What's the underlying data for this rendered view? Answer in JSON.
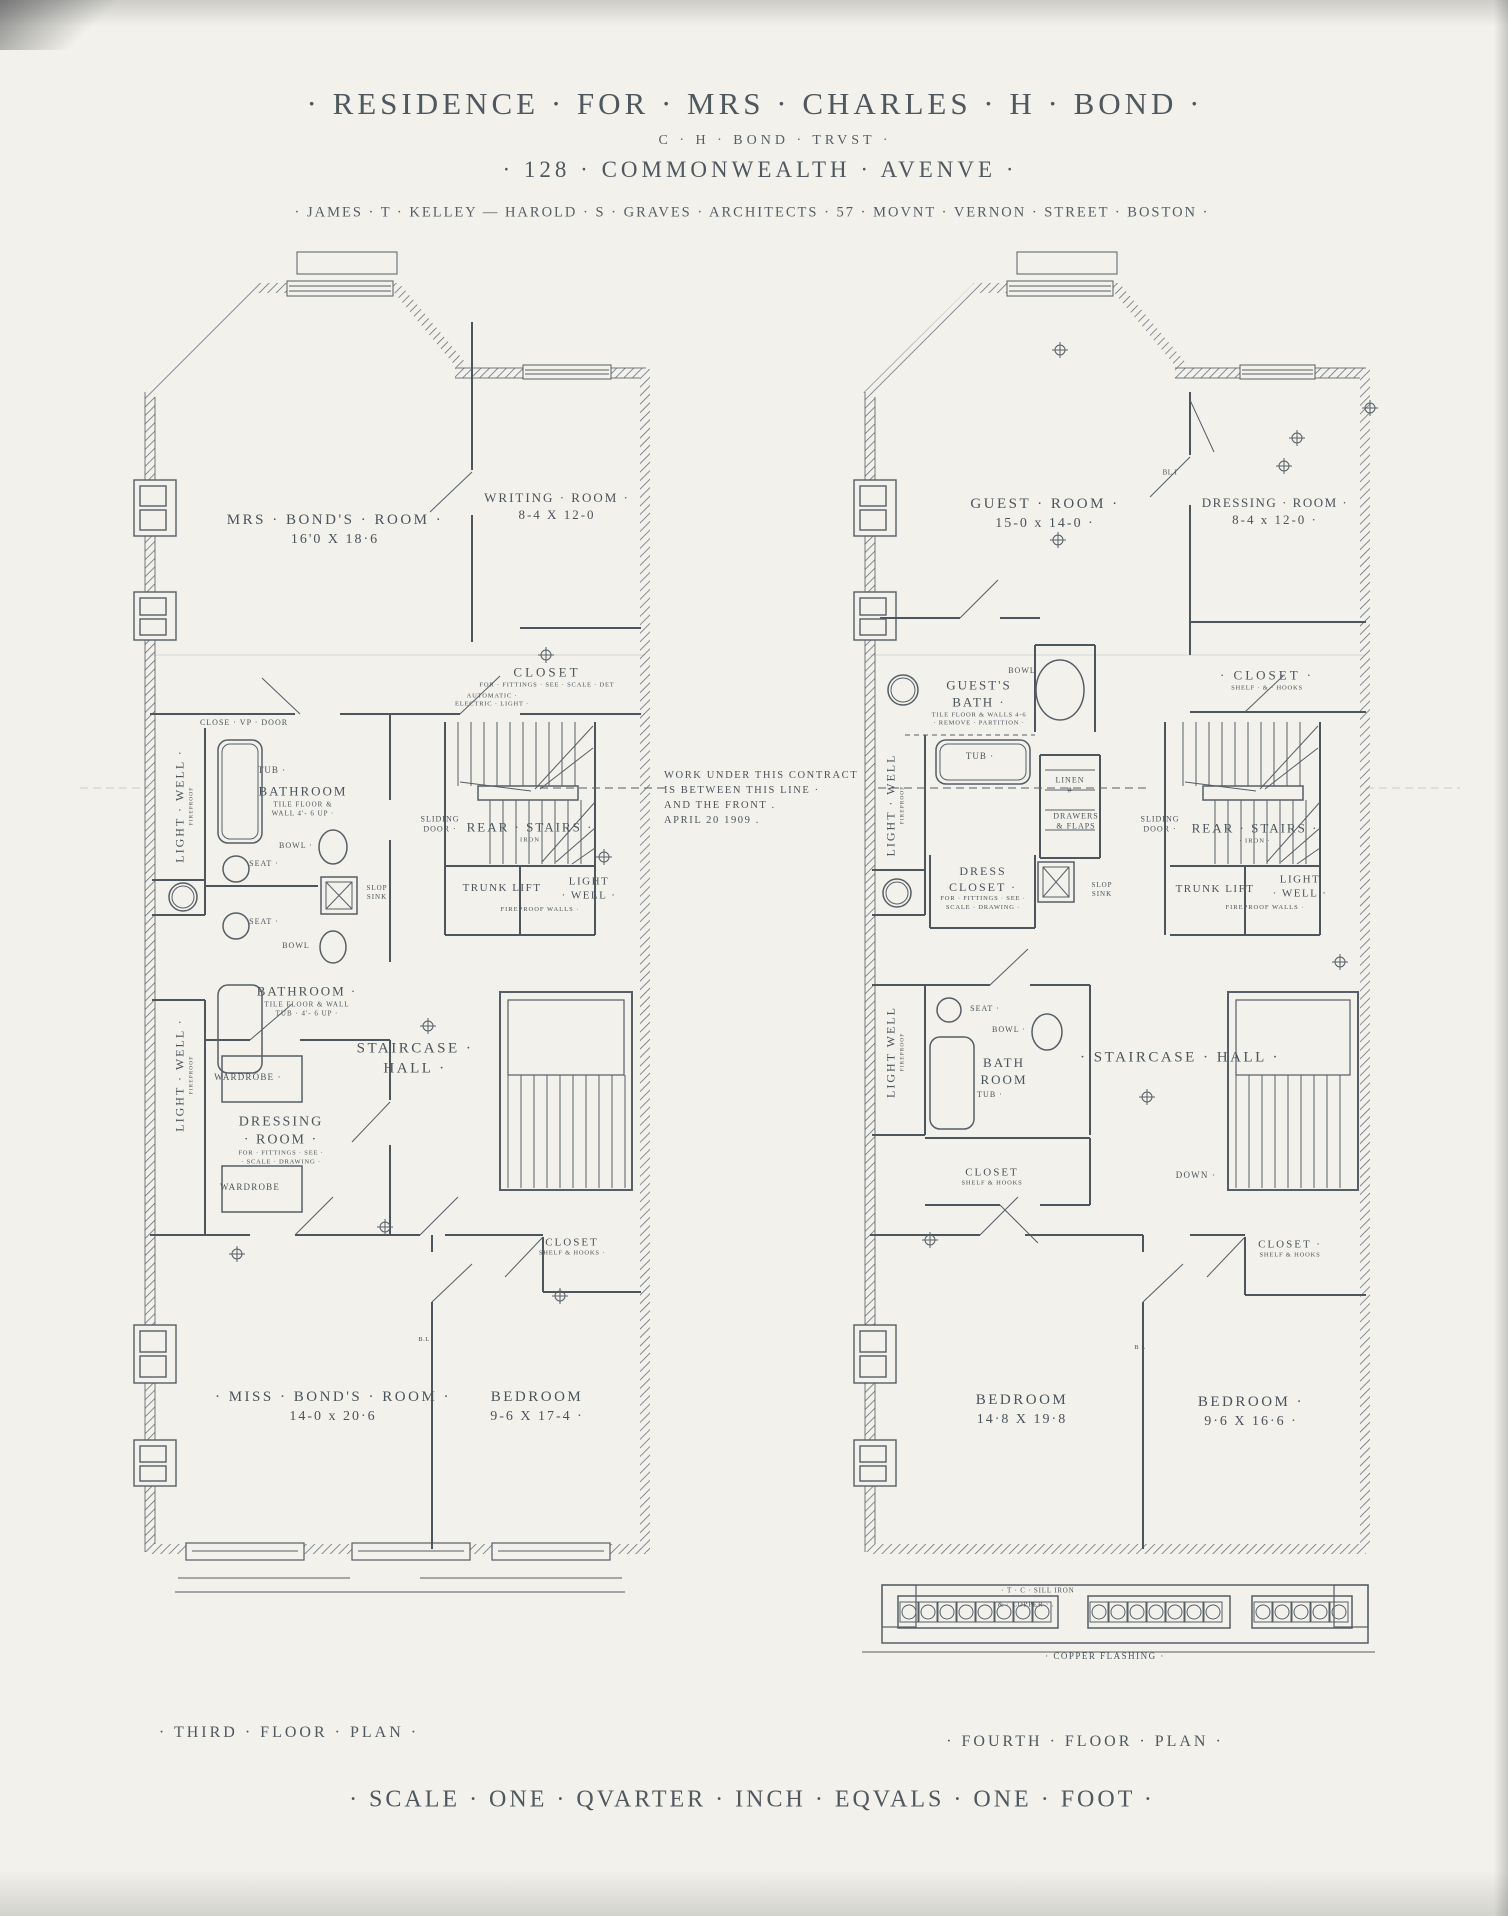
{
  "header": {
    "title": "· RESIDENCE · FOR · MRS · CHARLES · H · BOND ·",
    "trust": "C · H · BOND · TRVST ·",
    "address": "· 128 · COMMONWEALTH · AVENVE ·",
    "architects": "· JAMES · T · KELLEY — HAROLD · S · GRAVES · ARCHITECTS · 57 · MOVNT · VERNON · STREET · BOSTON ·"
  },
  "note": {
    "lines": [
      "WORK UNDER THIS CONTRACT",
      "IS  BETWEEN THIS LINE ·",
      "AND THE FRONT .",
      "APRIL 20 1909 ."
    ]
  },
  "footer": {
    "scale": "· SCALE · ONE · QVARTER · INCH · EQVALS · ONE · FOOT ·"
  },
  "plans": {
    "third": {
      "caption": "· THIRD · FLOOR · PLAN ·",
      "labels": [
        {
          "x": 335,
          "y": 530,
          "lines": [
            {
              "t": "MRS · BOND'S · ROOM ·",
              "fs": 15,
              "ls": 2.5
            },
            {
              "t": "16'0 X 18·6",
              "fs": 14,
              "ls": 2
            }
          ]
        },
        {
          "x": 557,
          "y": 507,
          "lines": [
            {
              "t": "WRITING · ROOM ·",
              "fs": 13,
              "ls": 2
            },
            {
              "t": "8-4 X 12-0",
              "fs": 13,
              "ls": 2
            }
          ]
        },
        {
          "x": 547,
          "y": 677,
          "lines": [
            {
              "t": "CLOSET",
              "fs": 13,
              "ls": 3
            },
            {
              "t": "FOR · FITTINGS · SEE · SCALE · DET",
              "fs": 6.5,
              "ls": 0.8
            }
          ]
        },
        {
          "x": 492,
          "y": 701,
          "lines": [
            {
              "t": "AUTOMATIC ·",
              "fs": 6.5,
              "ls": 0.8
            },
            {
              "t": "ELECTRIC · LIGHT ·",
              "fs": 6.5,
              "ls": 0.8
            }
          ]
        },
        {
          "x": 244,
          "y": 723,
          "lines": [
            {
              "t": "CLOSE · VP · DOOR",
              "fs": 8,
              "ls": 1
            }
          ]
        },
        {
          "x": 184,
          "y": 806,
          "rot": -90,
          "lines": [
            {
              "t": "LIGHT · WELL ·",
              "fs": 12,
              "ls": 2
            },
            {
              "t": "FIREPROOF",
              "fs": 5.5,
              "ls": 1
            }
          ]
        },
        {
          "x": 272,
          "y": 771,
          "lines": [
            {
              "t": "TUB ·",
              "fs": 9,
              "ls": 1
            }
          ]
        },
        {
          "x": 303,
          "y": 801,
          "lines": [
            {
              "t": "BATHROOM",
              "fs": 13,
              "ls": 2
            },
            {
              "t": "TILE  FLOOR  &",
              "fs": 7,
              "ls": 1
            },
            {
              "t": "WALL 4'- 6 UP ·",
              "fs": 7,
              "ls": 1
            }
          ]
        },
        {
          "x": 296,
          "y": 846,
          "lines": [
            {
              "t": "BOWL ·",
              "fs": 8,
              "ls": 1
            }
          ]
        },
        {
          "x": 264,
          "y": 864,
          "lines": [
            {
              "t": "SEAT ·",
              "fs": 8,
              "ls": 1
            }
          ]
        },
        {
          "x": 377,
          "y": 893,
          "lines": [
            {
              "t": "SLOP",
              "fs": 7,
              "ls": 1
            },
            {
              "t": "SINK",
              "fs": 7,
              "ls": 1
            }
          ]
        },
        {
          "x": 264,
          "y": 922,
          "lines": [
            {
              "t": "SEAT ·",
              "fs": 8,
              "ls": 1
            }
          ]
        },
        {
          "x": 296,
          "y": 946,
          "lines": [
            {
              "t": "BOWL",
              "fs": 8,
              "ls": 1
            }
          ]
        },
        {
          "x": 307,
          "y": 1001,
          "lines": [
            {
              "t": "BATHROOM ·",
              "fs": 13,
              "ls": 2
            },
            {
              "t": "TILE FLOOR & WALL",
              "fs": 7,
              "ls": 1
            },
            {
              "t": "TUB · 4'- 6 UP ·",
              "fs": 7,
              "ls": 1
            }
          ]
        },
        {
          "x": 440,
          "y": 825,
          "lines": [
            {
              "t": "SLIDING",
              "fs": 8,
              "ls": 1
            },
            {
              "t": "DOOR ·",
              "fs": 8,
              "ls": 1
            }
          ]
        },
        {
          "x": 530,
          "y": 832,
          "lines": [
            {
              "t": "REAR · STAIRS ·",
              "fs": 13,
              "ls": 2
            },
            {
              "t": "IRON",
              "fs": 6.5,
              "ls": 1
            }
          ]
        },
        {
          "x": 502,
          "y": 888,
          "lines": [
            {
              "t": "TRUNK LIFT",
              "fs": 11,
              "ls": 1.5
            }
          ]
        },
        {
          "x": 589,
          "y": 889,
          "lines": [
            {
              "t": "LIGHT",
              "fs": 11,
              "ls": 1.5
            },
            {
              "t": "· WELL ·",
              "fs": 11,
              "ls": 1.5
            }
          ]
        },
        {
          "x": 540,
          "y": 910,
          "lines": [
            {
              "t": "FIREPROOF  WALLS ·",
              "fs": 6.5,
              "ls": 1
            }
          ]
        },
        {
          "x": 184,
          "y": 1075,
          "rot": -90,
          "lines": [
            {
              "t": "LIGHT · WELL ·",
              "fs": 12,
              "ls": 2
            },
            {
              "t": "FIREPROOF",
              "fs": 5.5,
              "ls": 1
            }
          ]
        },
        {
          "x": 415,
          "y": 1059,
          "lines": [
            {
              "t": "STAIRCASE ·",
              "fs": 15,
              "ls": 2.5
            },
            {
              "t": "HALL ·",
              "fs": 15,
              "ls": 2.5
            }
          ]
        },
        {
          "x": 248,
          "y": 1078,
          "lines": [
            {
              "t": "WARDROBE ·",
              "fs": 9,
              "ls": 1.2
            }
          ]
        },
        {
          "x": 281,
          "y": 1140,
          "lines": [
            {
              "t": "DRESSING",
              "fs": 14,
              "ls": 2
            },
            {
              "t": "· ROOM ·",
              "fs": 14,
              "ls": 2
            },
            {
              "t": "FOR · FITTINGS · SEE ·",
              "fs": 6.5,
              "ls": 0.8
            },
            {
              "t": "· SCALE · DRAWING ·",
              "fs": 6.5,
              "ls": 0.8
            }
          ]
        },
        {
          "x": 250,
          "y": 1188,
          "lines": [
            {
              "t": "WARDROBE",
              "fs": 9,
              "ls": 1.2
            }
          ]
        },
        {
          "x": 572,
          "y": 1247,
          "lines": [
            {
              "t": "CLOSET",
              "fs": 11,
              "ls": 2
            },
            {
              "t": "SHELF & HOOKS ·",
              "fs": 6.5,
              "ls": 0.8
            }
          ]
        },
        {
          "x": 424,
          "y": 1340,
          "lines": [
            {
              "t": "B.L",
              "fs": 6.5,
              "ls": 0.5
            }
          ]
        },
        {
          "x": 333,
          "y": 1407,
          "lines": [
            {
              "t": "· MISS · BOND'S · ROOM ·",
              "fs": 15,
              "ls": 2.5
            },
            {
              "t": "14-0 x 20·6",
              "fs": 14,
              "ls": 2
            }
          ]
        },
        {
          "x": 537,
          "y": 1407,
          "lines": [
            {
              "t": "BEDROOM",
              "fs": 15,
              "ls": 2.5
            },
            {
              "t": "9-6 X 17-4 ·",
              "fs": 14,
              "ls": 2
            }
          ]
        }
      ]
    },
    "fourth": {
      "caption": "· FOURTH · FLOOR · PLAN ·",
      "labels": [
        {
          "x": 1045,
          "y": 514,
          "lines": [
            {
              "t": "GUEST · ROOM ·",
              "fs": 15,
              "ls": 2.5
            },
            {
              "t": "15-0  x  14-0 ·",
              "fs": 14,
              "ls": 2
            }
          ]
        },
        {
          "x": 1275,
          "y": 512,
          "lines": [
            {
              "t": "DRESSING · ROOM ·",
              "fs": 13,
              "ls": 1.5
            },
            {
              "t": "8-4 x 12-0 ·",
              "fs": 13,
              "ls": 2
            }
          ]
        },
        {
          "x": 1170,
          "y": 473,
          "lines": [
            {
              "t": "BL  I",
              "fs": 7,
              "ls": 0.5
            }
          ]
        },
        {
          "x": 1267,
          "y": 680,
          "lines": [
            {
              "t": "· CLOSET ·",
              "fs": 13,
              "ls": 3
            },
            {
              "t": "SHELF · & · HOOKS",
              "fs": 6.5,
              "ls": 0.8
            }
          ]
        },
        {
          "x": 1022,
          "y": 671,
          "lines": [
            {
              "t": "BOWL",
              "fs": 8,
              "ls": 1
            }
          ]
        },
        {
          "x": 979,
          "y": 703,
          "lines": [
            {
              "t": "GUEST'S",
              "fs": 13,
              "ls": 2
            },
            {
              "t": "BATH ·",
              "fs": 13,
              "ls": 2
            },
            {
              "t": "TILE FLOOR & WALLS 4-6",
              "fs": 6.5,
              "ls": 0.8
            },
            {
              "t": "· REMOVE · PARTITION ·",
              "fs": 6.5,
              "ls": 0.8
            }
          ]
        },
        {
          "x": 980,
          "y": 757,
          "lines": [
            {
              "t": "TUB ·",
              "fs": 9,
              "ls": 1
            }
          ]
        },
        {
          "x": 895,
          "y": 805,
          "rot": -90,
          "lines": [
            {
              "t": "LIGHT · WELL",
              "fs": 12,
              "ls": 2
            },
            {
              "t": "FIREPROOF",
              "fs": 5.5,
              "ls": 1
            }
          ]
        },
        {
          "x": 1070,
          "y": 786,
          "lines": [
            {
              "t": "LINEN",
              "fs": 8,
              "ls": 1
            },
            {
              "t": "#",
              "fs": 8,
              "ls": 1
            }
          ]
        },
        {
          "x": 1076,
          "y": 822,
          "lines": [
            {
              "t": "DRAWERS",
              "fs": 8,
              "ls": 1
            },
            {
              "t": "& FLAPS",
              "fs": 8,
              "ls": 1
            }
          ]
        },
        {
          "x": 983,
          "y": 888,
          "lines": [
            {
              "t": "DRESS",
              "fs": 12,
              "ls": 2
            },
            {
              "t": "CLOSET ·",
              "fs": 12,
              "ls": 2
            },
            {
              "t": "FOR · FITTINGS · SEE ·",
              "fs": 6.5,
              "ls": 0.8
            },
            {
              "t": "SCALE · DRAWING ·",
              "fs": 6.5,
              "ls": 0.8
            }
          ]
        },
        {
          "x": 1102,
          "y": 890,
          "lines": [
            {
              "t": "SLOP",
              "fs": 7,
              "ls": 1
            },
            {
              "t": "SINK",
              "fs": 7,
              "ls": 1
            }
          ]
        },
        {
          "x": 1160,
          "y": 825,
          "lines": [
            {
              "t": "SLIDING",
              "fs": 8,
              "ls": 1
            },
            {
              "t": "DOOR ·",
              "fs": 8,
              "ls": 1
            }
          ]
        },
        {
          "x": 1255,
          "y": 833,
          "lines": [
            {
              "t": "REAR · STAIRS ·",
              "fs": 13,
              "ls": 2
            },
            {
              "t": "· IRON ·",
              "fs": 6.5,
              "ls": 1
            }
          ]
        },
        {
          "x": 1215,
          "y": 889,
          "lines": [
            {
              "t": "TRUNK LIFT",
              "fs": 11,
              "ls": 1.5
            }
          ]
        },
        {
          "x": 1300,
          "y": 887,
          "lines": [
            {
              "t": "LIGHT",
              "fs": 11,
              "ls": 1.5
            },
            {
              "t": "· WELL ·",
              "fs": 11,
              "ls": 1.5
            }
          ]
        },
        {
          "x": 1265,
          "y": 908,
          "lines": [
            {
              "t": "FIREPROOF  WALLS ·",
              "fs": 6.5,
              "ls": 1
            }
          ]
        },
        {
          "x": 895,
          "y": 1052,
          "rot": -90,
          "lines": [
            {
              "t": "LIGHT  WELL",
              "fs": 12,
              "ls": 2
            },
            {
              "t": "FIREPROOF",
              "fs": 5.5,
              "ls": 1
            }
          ]
        },
        {
          "x": 985,
          "y": 1009,
          "lines": [
            {
              "t": "SEAT ·",
              "fs": 8,
              "ls": 1
            }
          ]
        },
        {
          "x": 1009,
          "y": 1030,
          "lines": [
            {
              "t": "BOWL ·",
              "fs": 8,
              "ls": 1
            }
          ]
        },
        {
          "x": 1004,
          "y": 1072,
          "lines": [
            {
              "t": "BATH",
              "fs": 13,
              "ls": 2
            },
            {
              "t": "ROOM",
              "fs": 13,
              "ls": 2
            }
          ]
        },
        {
          "x": 990,
          "y": 1095,
          "lines": [
            {
              "t": "TUB ·",
              "fs": 8,
              "ls": 1
            }
          ]
        },
        {
          "x": 1180,
          "y": 1058,
          "lines": [
            {
              "t": "· STAIRCASE · HALL ·",
              "fs": 15,
              "ls": 2.5
            }
          ]
        },
        {
          "x": 992,
          "y": 1177,
          "lines": [
            {
              "t": "CLOSET",
              "fs": 11,
              "ls": 2
            },
            {
              "t": "SHELF & HOOKS",
              "fs": 6.5,
              "ls": 0.8
            }
          ]
        },
        {
          "x": 1196,
          "y": 1176,
          "lines": [
            {
              "t": "DOWN ·",
              "fs": 9,
              "ls": 1.2
            }
          ]
        },
        {
          "x": 1290,
          "y": 1249,
          "lines": [
            {
              "t": "CLOSET ·",
              "fs": 11,
              "ls": 2
            },
            {
              "t": "SHELF & HOOKS",
              "fs": 6.5,
              "ls": 0.8
            }
          ]
        },
        {
          "x": 1140,
          "y": 1348,
          "lines": [
            {
              "t": "B L",
              "fs": 6.5,
              "ls": 0.5
            }
          ]
        },
        {
          "x": 1022,
          "y": 1410,
          "lines": [
            {
              "t": "BEDROOM",
              "fs": 15,
              "ls": 2.5
            },
            {
              "t": "14·8 X 19·8",
              "fs": 14,
              "ls": 2
            }
          ]
        },
        {
          "x": 1251,
          "y": 1412,
          "lines": [
            {
              "t": "BEDROOM ·",
              "fs": 15,
              "ls": 2.5
            },
            {
              "t": "9·6 X 16·6 ·",
              "fs": 14,
              "ls": 2
            }
          ]
        },
        {
          "x": 1038,
          "y": 1591,
          "lines": [
            {
              "t": "· T · C · SILL IRON",
              "fs": 7,
              "ls": 0.8
            }
          ]
        },
        {
          "x": 1026,
          "y": 1605,
          "lines": [
            {
              "t": "& · COPPER · .",
              "fs": 7,
              "ls": 0.8
            }
          ]
        },
        {
          "x": 1105,
          "y": 1657,
          "lines": [
            {
              "t": "· COPPER  FLASHING ·",
              "fs": 9,
              "ls": 1.5
            }
          ]
        }
      ]
    }
  }
}
